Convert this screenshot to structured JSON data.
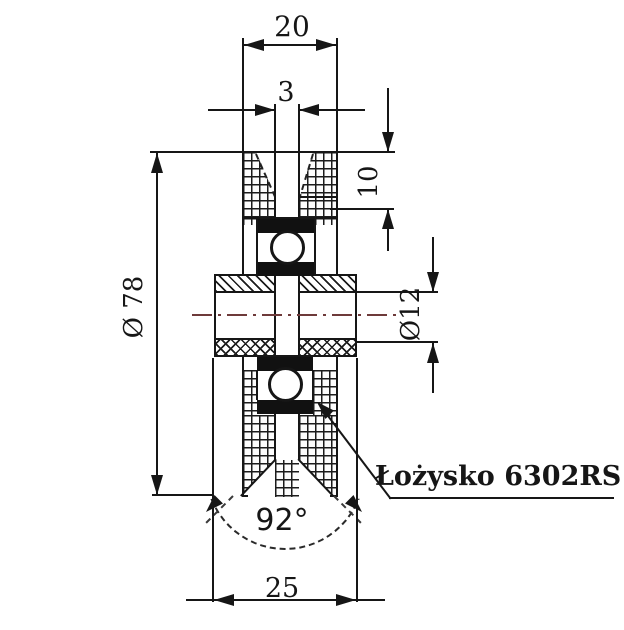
{
  "drawing": {
    "type_label": "technical-section-drawing",
    "part": "V-groove roller wheel with ball bearing",
    "callout": {
      "label": "Łożysko 6302RS"
    },
    "dimensions": {
      "rim_width": "20",
      "groove_slot_width": "3",
      "groove_depth": "10",
      "outer_diameter": "Ø 78",
      "bore_diameter": "Ø12",
      "groove_angle": "92°",
      "hub_width": "25"
    },
    "colors": {
      "line": "#161616",
      "centerline_accent": "#6e3a3a",
      "background": "#ffffff",
      "bearing_seal": "#111111"
    }
  }
}
